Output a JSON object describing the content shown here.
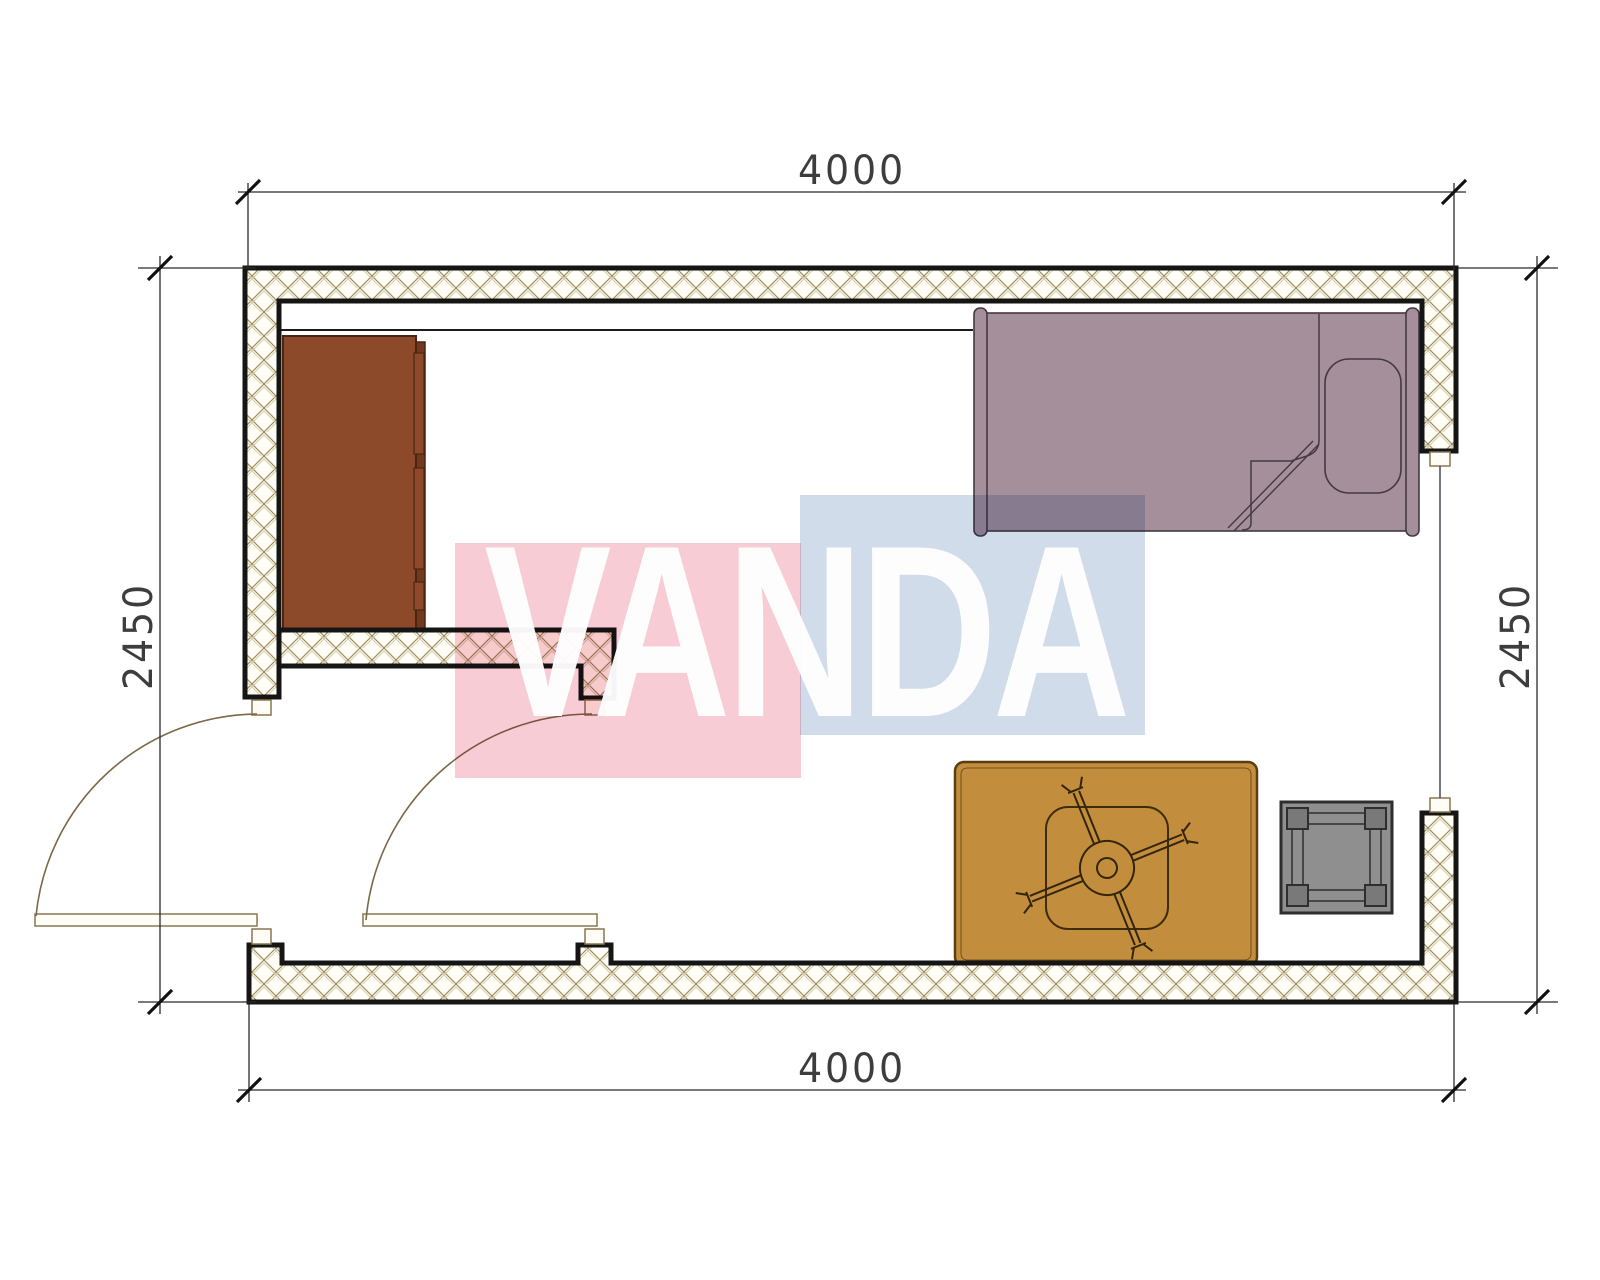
{
  "title": "Room floor plan",
  "dimensions": {
    "top": "4000",
    "bottom": "4000",
    "left": "2450",
    "right": "2450"
  },
  "watermark": {
    "text": "VANDA",
    "pink_color": "#f6c6d0",
    "blue_color": "#ccd8e9",
    "text_color": "#ffffff"
  },
  "plan": {
    "wall_fill": "#fffdf5",
    "wall_hatch_color": "#9d8c60",
    "wall_border_color": "#151515",
    "dimension_line_color": "#2b2b2b",
    "door_symbol_color": "#8a7750",
    "furniture": [
      {
        "name": "wardrobe",
        "color": "#8d4a2b"
      },
      {
        "name": "single-bed",
        "color": "#a48f9b"
      },
      {
        "name": "pillow",
        "color": "#a48f9b"
      },
      {
        "name": "rug",
        "color": "#c28e3d"
      },
      {
        "name": "rotary-dryer-fan",
        "color": "#33250a"
      },
      {
        "name": "stool-table",
        "color": "#8f8f8f"
      }
    ],
    "openings": [
      "entrance-door",
      "vestibule-door",
      "window"
    ]
  }
}
